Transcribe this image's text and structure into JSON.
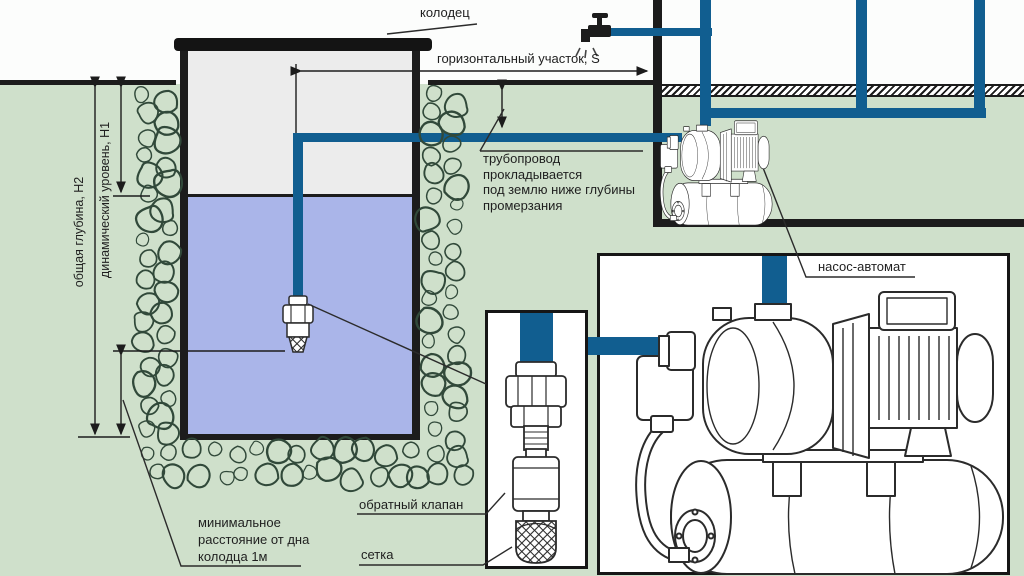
{
  "diagram": {
    "labels": {
      "well": "колодец",
      "horizontal_section": "горизонтальный участок, S",
      "pipe_note": [
        "трубопровод",
        "прокладывается",
        "под землю ниже глубины",
        "промерзания"
      ],
      "total_depth": "общая глубина, Н2",
      "dynamic_level": "динамический уровень, Н1",
      "min_distance": [
        "минимальное",
        "расстояние от дна",
        "колодца 1м"
      ],
      "check_valve": "обратный клапан",
      "mesh": "сетка",
      "pump_auto": "насос-автомат"
    },
    "colors": {
      "pipe": "#115e90",
      "ground": "#cfe0cb",
      "water": "#aab5e9",
      "well_interior": "#ececec",
      "line": "#1c1c1c",
      "stone": "#31493a"
    }
  }
}
